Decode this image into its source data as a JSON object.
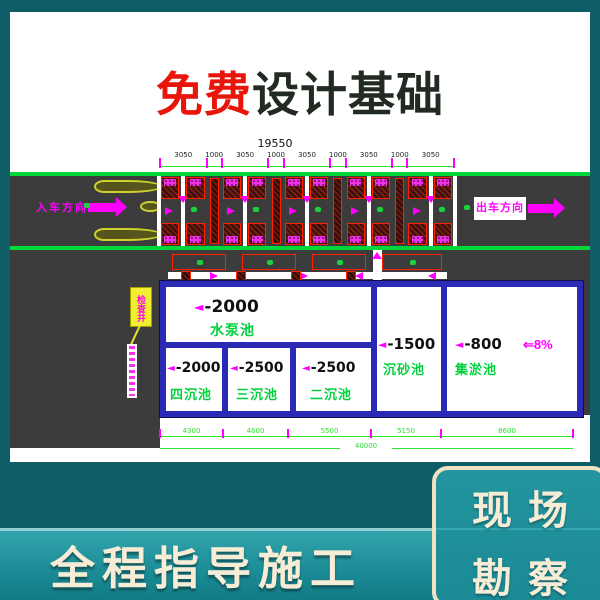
{
  "banner": {
    "highlight": "免费",
    "rest": "设计基础"
  },
  "drawing": {
    "overall_top_dim": "19550",
    "top_segments": [
      "3050",
      "1000",
      "3050",
      "1000",
      "3050",
      "1000",
      "3050",
      "1000",
      "3050"
    ],
    "entry_label": "入车方向",
    "exit_label": "出车方向",
    "callout_label": "检查井",
    "slope_label": "⇐8%",
    "depth_marker": "◄",
    "pools": {
      "pump": {
        "depth": "-2000",
        "name": "水泵池"
      },
      "sand": {
        "depth": "-1500",
        "name": "沉砂池"
      },
      "silt": {
        "depth": "-800",
        "name": "集淤池"
      },
      "four": {
        "depth": "-2000",
        "name": "四沉池"
      },
      "three": {
        "depth": "-2500",
        "name": "三沉池"
      },
      "two": {
        "depth": "-2500",
        "name": "二沉池"
      }
    },
    "bottom_segments": [
      "4300",
      "4600",
      "5500",
      "5150",
      "8600"
    ],
    "overall_bottom_dim": "40000"
  },
  "footer": {
    "left_banner": "全程指导施工",
    "badge_line1": "现场",
    "badge_line2": "勘察"
  },
  "colors": {
    "background_teal": "#0e5d67",
    "banner_red": "#e8150b",
    "banner_dark": "#222b22",
    "cad_green": "#00d23c",
    "cad_magenta": "#ff00ff",
    "wall_blue": "#2b2ab5",
    "road_gray": "#3c3c3c",
    "cream_text": "#f6ecd4"
  }
}
